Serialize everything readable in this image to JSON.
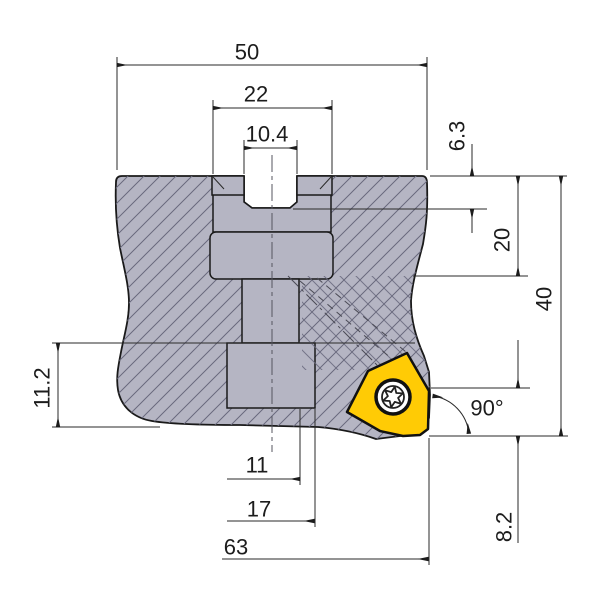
{
  "labels": {
    "top_width": "50",
    "hub_width": "22",
    "slot_width": "10.4",
    "slot_depth": "6.3",
    "step_height": "20",
    "overall_height": "40",
    "flange_height": "11.2",
    "corner_angle": "90°",
    "bore_dim_1": "11",
    "bore_dim_2": "17",
    "cutting_diameter": "63",
    "edge_height": "8.2"
  },
  "colors": {
    "body": "#b5b5c3",
    "insert": "#ffcb05",
    "outline": "#1a1a1a",
    "hatch": "#69697d"
  }
}
